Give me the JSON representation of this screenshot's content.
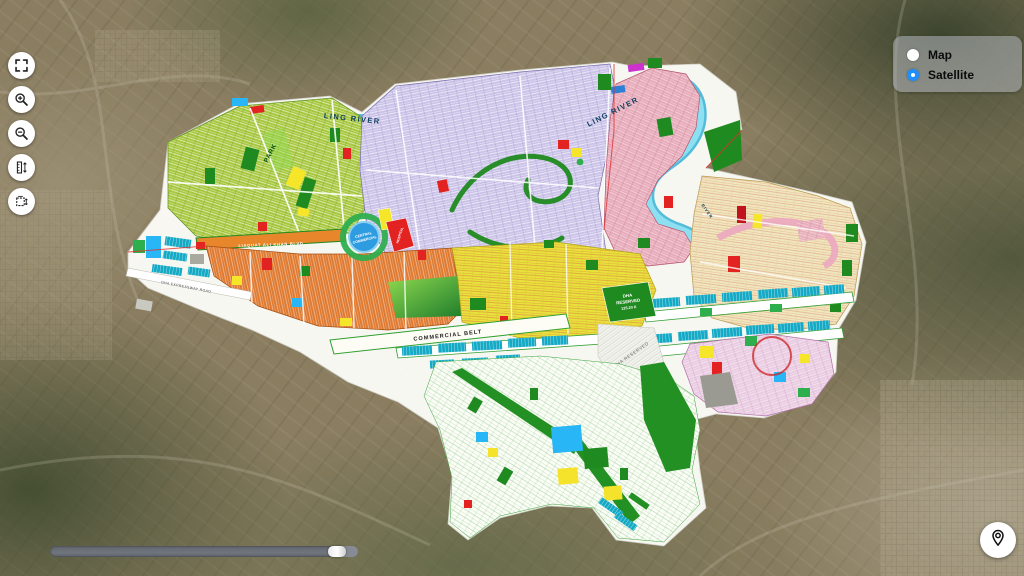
{
  "layer_panel": {
    "options": [
      {
        "label": "Map",
        "selected": false
      },
      {
        "label": "Satellite",
        "selected": true
      }
    ],
    "selected_color": "#1f8fff"
  },
  "toolbar": {
    "buttons": [
      {
        "name": "fullscreen",
        "icon": "fullscreen-icon"
      },
      {
        "name": "zoom-in",
        "icon": "zoom-in-icon"
      },
      {
        "name": "zoom-out",
        "icon": "zoom-out-icon"
      },
      {
        "name": "measure-distance",
        "icon": "ruler-icon"
      },
      {
        "name": "measure-area",
        "icon": "area-measure-icon"
      }
    ]
  },
  "opacity_slider": {
    "value_percent": 96
  },
  "locate_button": {
    "icon": "location-pin-icon"
  },
  "overlay": {
    "labels": {
      "river_1": "LING RIVER",
      "river_2": "LING RIVER",
      "river_3": "RIVER",
      "central_commercial_line1": "CENTRAL",
      "central_commercial_line2": "COMMERCIAL",
      "commercial_belt": "COMMERCIAL BELT",
      "boulevard": "LIAQUAT ALI KHAN BLVD",
      "park": "PARK",
      "expressway": "DHA EXPRESSWAY ROAD",
      "reserved_line1": "DHA",
      "reserved_line2": "RESERVED",
      "reserved_line3": "125.20 K",
      "reserved_area": "DHA RESERVED",
      "hospital": "HOSPITAL"
    },
    "colors": {
      "river": "#8ce0f2",
      "residential_green": "#a7c83e",
      "residential_purple": "#cbc3e8",
      "residential_rose": "#e7abba",
      "residential_cream": "#f1e7bd",
      "residential_orange": "#df7a30",
      "residential_yellow": "#e9e23c",
      "residential_pink": "#eacce2",
      "commercial_teal": "#14a9c5",
      "park_green": "#1f8a1f",
      "central_commercial_blue": "#2d9ce0"
    }
  }
}
